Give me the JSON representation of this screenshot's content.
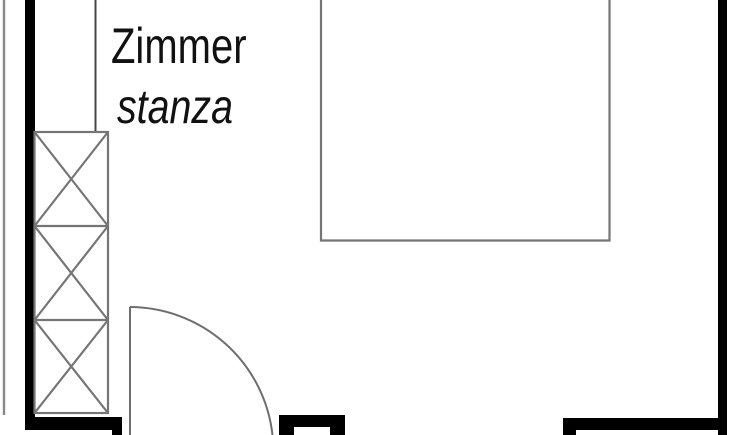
{
  "room": {
    "label_de": "Zimmer",
    "label_it": "stanza"
  },
  "plan": {
    "wardrobe_sections": 3,
    "symbols": {
      "wardrobe": "crossed-box wardrobe symbol",
      "door": "quarter-circle door swing",
      "bed": "open-top furniture rectangle"
    },
    "colors": {
      "wall": "#000000",
      "furniture_line": "#757575",
      "door_line": "#6e6e6e",
      "duct_line": "#454545",
      "outer_edge_line": "#888888",
      "label_text": "#111111",
      "background": "#ffffff"
    }
  }
}
